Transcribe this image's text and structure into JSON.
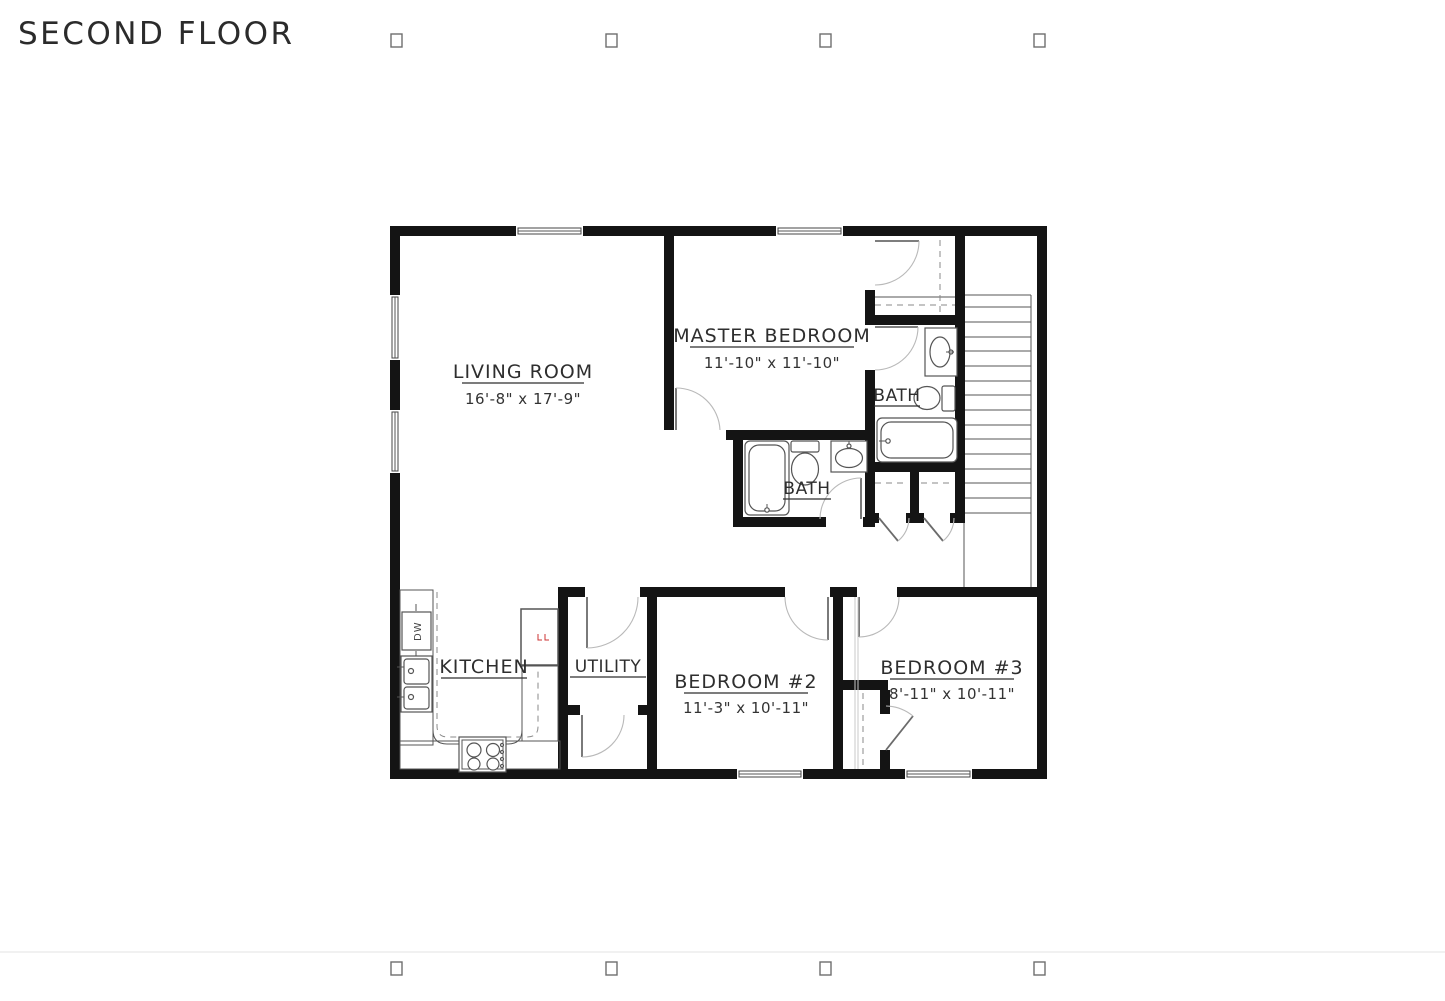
{
  "page": {
    "title": "SECOND FLOOR"
  },
  "rooms": {
    "living": {
      "name": "LIVING ROOM",
      "dims": "16'-8\" x 17'-9\""
    },
    "master": {
      "name": "MASTER BEDROOM",
      "dims": "11'-10\" x 11'-10\""
    },
    "master_bath": {
      "name": "BATH"
    },
    "hall_bath": {
      "name": "BATH"
    },
    "kitchen": {
      "name": "KITCHEN"
    },
    "utility": {
      "name": "UTILITY"
    },
    "bedroom2": {
      "name": "BEDROOM #2",
      "dims": "11'-3\" x 10'-11\""
    },
    "bedroom3": {
      "name": "BEDROOM #3",
      "dims": "8'-11\" x 10'-11\""
    }
  },
  "appliances": {
    "dishwasher_label": "DW"
  }
}
